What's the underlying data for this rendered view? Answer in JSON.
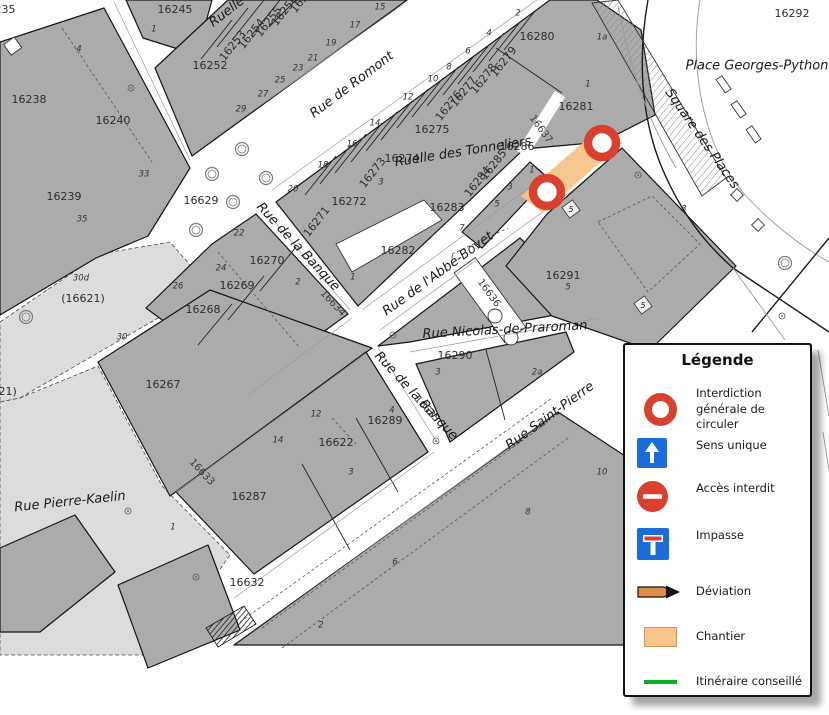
{
  "map": {
    "parcel_labels": [
      {
        "t": "16235",
        "x": -2,
        "y": 10
      },
      {
        "t": "16245",
        "x": 175,
        "y": 10
      },
      {
        "t": "16252",
        "x": 210,
        "y": 66
      },
      {
        "t": "16238",
        "x": 29,
        "y": 100
      },
      {
        "t": "16240",
        "x": 113,
        "y": 121
      },
      {
        "t": "16239",
        "x": 64,
        "y": 197
      },
      {
        "t": "16629",
        "x": 201,
        "y": 201
      },
      {
        "t": "16253",
        "x": 233,
        "y": 46,
        "r": -52
      },
      {
        "t": "16254",
        "x": 252,
        "y": 34,
        "r": -52
      },
      {
        "t": "16255",
        "x": 269,
        "y": 22,
        "r": -52
      },
      {
        "t": "16256",
        "x": 285,
        "y": 11,
        "r": -52
      },
      {
        "t": "16257",
        "x": 304,
        "y": -2,
        "r": -52
      },
      {
        "t": "16280",
        "x": 537,
        "y": 37
      },
      {
        "t": "16281",
        "x": 576,
        "y": 107
      },
      {
        "t": "16279",
        "x": 504,
        "y": 62,
        "r": -52
      },
      {
        "t": "16278",
        "x": 484,
        "y": 79,
        "r": -52
      },
      {
        "t": "16277",
        "x": 464,
        "y": 92,
        "r": -52
      },
      {
        "t": "16276",
        "x": 449,
        "y": 106,
        "r": -52
      },
      {
        "t": "16275",
        "x": 432,
        "y": 130
      },
      {
        "t": "16274",
        "x": 402,
        "y": 159
      },
      {
        "t": "16273",
        "x": 373,
        "y": 173,
        "r": -52
      },
      {
        "t": "16272",
        "x": 349,
        "y": 202
      },
      {
        "t": "16271",
        "x": 317,
        "y": 222,
        "r": -52
      },
      {
        "t": "16286",
        "x": 517,
        "y": 147
      },
      {
        "t": "16285",
        "x": 494,
        "y": 165,
        "r": -52
      },
      {
        "t": "16284",
        "x": 478,
        "y": 182,
        "r": -52
      },
      {
        "t": "16283",
        "x": 447,
        "y": 208
      },
      {
        "t": "16282",
        "x": 398,
        "y": 251
      },
      {
        "t": "16270",
        "x": 267,
        "y": 261
      },
      {
        "t": "16269",
        "x": 237,
        "y": 286
      },
      {
        "t": "16268",
        "x": 203,
        "y": 310
      },
      {
        "t": "16267",
        "x": 163,
        "y": 385
      },
      {
        "t": "16291",
        "x": 563,
        "y": 276
      },
      {
        "t": "16290",
        "x": 455,
        "y": 356
      },
      {
        "t": "16289",
        "x": 385,
        "y": 421
      },
      {
        "t": "16622",
        "x": 336,
        "y": 443
      },
      {
        "t": "16287",
        "x": 249,
        "y": 497
      },
      {
        "t": "16632",
        "x": 247,
        "y": 583
      },
      {
        "t": "16292",
        "x": 792,
        "y": 14
      },
      {
        "t": "(16621)",
        "x": 83,
        "y": 299
      },
      {
        "t": "(16621)",
        "x": -5,
        "y": 392
      }
    ],
    "street_parcel_labels": [
      {
        "t": "16637",
        "x": 541,
        "y": 129,
        "r": 54
      },
      {
        "t": "16636",
        "x": 489,
        "y": 293,
        "r": 54
      },
      {
        "t": "16634",
        "x": 333,
        "y": 303,
        "r": 47
      },
      {
        "t": "16635",
        "x": 427,
        "y": 409,
        "r": 47
      },
      {
        "t": "16633",
        "x": 202,
        "y": 472,
        "r": 47
      }
    ],
    "street_labels": [
      {
        "t": "Rue de Romont",
        "x": 352,
        "y": 85,
        "r": -37
      },
      {
        "t": "Ruelle des Tonneliers",
        "x": 463,
        "y": 152,
        "r": -9
      },
      {
        "t": "Rue de l'Abbé-Bovet",
        "x": 438,
        "y": 274,
        "r": -36,
        "anchor": "start"
      },
      {
        "t": "Rue de la Banque",
        "x": 298,
        "y": 247,
        "r": 47
      },
      {
        "t": "Rue de la Banque",
        "x": 416,
        "y": 396,
        "r": 47
      },
      {
        "t": "Rue Nicolas-de-Praroman",
        "x": 505,
        "y": 330,
        "r": -3
      },
      {
        "t": "Rue Saint-Pierre",
        "x": 550,
        "y": 416,
        "r": -36,
        "anchor": "start"
      },
      {
        "t": "Rue Pierre-Kaelin",
        "x": 70,
        "y": 502,
        "r": -6
      },
      {
        "t": "Square des Places",
        "x": 702,
        "y": 139,
        "r": 55
      },
      {
        "t": "Place Georges-Python",
        "x": 757,
        "y": 66,
        "anchor": "start"
      },
      {
        "t": "Ruelle",
        "x": 227,
        "y": 12,
        "r": -38
      }
    ],
    "house_numbers": [
      {
        "t": "1",
        "x": 154,
        "y": 29
      },
      {
        "t": "4",
        "x": 79,
        "y": 49
      },
      {
        "t": "33",
        "x": 144,
        "y": 174
      },
      {
        "t": "35",
        "x": 82,
        "y": 219
      },
      {
        "t": "29",
        "x": 241,
        "y": 109
      },
      {
        "t": "27",
        "x": 263,
        "y": 94
      },
      {
        "t": "25",
        "x": 280,
        "y": 80
      },
      {
        "t": "23",
        "x": 298,
        "y": 68
      },
      {
        "t": "21",
        "x": 313,
        "y": 58
      },
      {
        "t": "19",
        "x": 331,
        "y": 43
      },
      {
        "t": "17",
        "x": 355,
        "y": 25
      },
      {
        "t": "15",
        "x": 380,
        "y": 7
      },
      {
        "t": "2",
        "x": 518,
        "y": 13
      },
      {
        "t": "4",
        "x": 489,
        "y": 33
      },
      {
        "t": "6",
        "x": 468,
        "y": 51
      },
      {
        "t": "8",
        "x": 449,
        "y": 67
      },
      {
        "t": "10",
        "x": 433,
        "y": 79
      },
      {
        "t": "12",
        "x": 408,
        "y": 97
      },
      {
        "t": "14",
        "x": 375,
        "y": 123
      },
      {
        "t": "16",
        "x": 352,
        "y": 144
      },
      {
        "t": "18",
        "x": 323,
        "y": 165
      },
      {
        "t": "20",
        "x": 293,
        "y": 189
      },
      {
        "t": "22",
        "x": 239,
        "y": 233
      },
      {
        "t": "24",
        "x": 221,
        "y": 268
      },
      {
        "t": "26",
        "x": 178,
        "y": 286
      },
      {
        "t": "1a",
        "x": 602,
        "y": 37
      },
      {
        "t": "1",
        "x": 588,
        "y": 84
      },
      {
        "t": "3",
        "x": 684,
        "y": 209
      },
      {
        "t": "1",
        "x": 532,
        "y": 170
      },
      {
        "t": "3",
        "x": 510,
        "y": 187
      },
      {
        "t": "5",
        "x": 497,
        "y": 204
      },
      {
        "t": "7",
        "x": 462,
        "y": 228
      },
      {
        "t": "3",
        "x": 381,
        "y": 182
      },
      {
        "t": "1",
        "x": 353,
        "y": 277
      },
      {
        "t": "2",
        "x": 298,
        "y": 282
      },
      {
        "t": "30d",
        "x": 81,
        "y": 278
      },
      {
        "t": "30",
        "x": 122,
        "y": 337
      },
      {
        "t": "5",
        "x": 568,
        "y": 287
      },
      {
        "t": "3",
        "x": 438,
        "y": 372
      },
      {
        "t": "2a",
        "x": 537,
        "y": 372
      },
      {
        "t": "4",
        "x": 392,
        "y": 410
      },
      {
        "t": "12",
        "x": 316,
        "y": 414
      },
      {
        "t": "3",
        "x": 351,
        "y": 472
      },
      {
        "t": "14",
        "x": 278,
        "y": 440
      },
      {
        "t": "1",
        "x": 173,
        "y": 527
      },
      {
        "t": "10",
        "x": 602,
        "y": 472
      },
      {
        "t": "8",
        "x": 528,
        "y": 512
      },
      {
        "t": "6",
        "x": 395,
        "y": 562
      },
      {
        "t": "2",
        "x": 321,
        "y": 625
      }
    ],
    "house_badges": [
      {
        "t": "5",
        "x": 571,
        "y": 209
      },
      {
        "t": "5",
        "x": 643,
        "y": 305
      }
    ]
  },
  "legend": {
    "title": "Légende",
    "items": [
      {
        "icon": "no-traffic-ring-icon",
        "label": "Interdiction générale de circuler"
      },
      {
        "icon": "one-way-icon",
        "label": "Sens unique"
      },
      {
        "icon": "no-entry-icon",
        "label": "Accès interdit"
      },
      {
        "icon": "dead-end-icon",
        "label": "Impasse"
      },
      {
        "icon": "detour-icon",
        "label": "Déviation"
      },
      {
        "icon": "worksite-icon",
        "label": "Chantier"
      },
      {
        "icon": "route-icon",
        "label": "Itinéraire conseillé"
      }
    ]
  },
  "colors": {
    "closure_red": "#D9402E",
    "sign_blue": "#1B6ED9",
    "worksite_orange": "#F8C489",
    "detour_orange": "#DE8F45",
    "route_green": "#00B02B",
    "building_gray": "#ABABAB",
    "surface_light": "#DCDCDC"
  }
}
